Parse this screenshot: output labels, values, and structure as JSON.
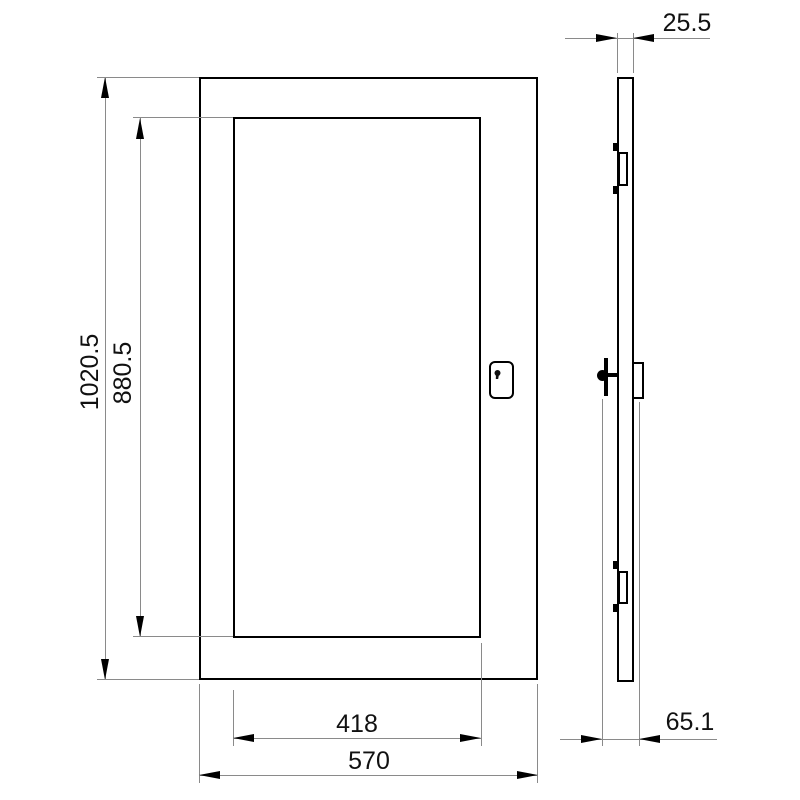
{
  "dimensions": {
    "outer_height": "1020.5",
    "inner_height": "880.5",
    "window_width": "418",
    "outer_width": "570",
    "door_thickness": "25.5",
    "overall_depth": "65.1"
  },
  "colors": {
    "background": "#ffffff",
    "outline": "#000000",
    "dimension_line": "#8a8a8a",
    "text": "#111111"
  }
}
